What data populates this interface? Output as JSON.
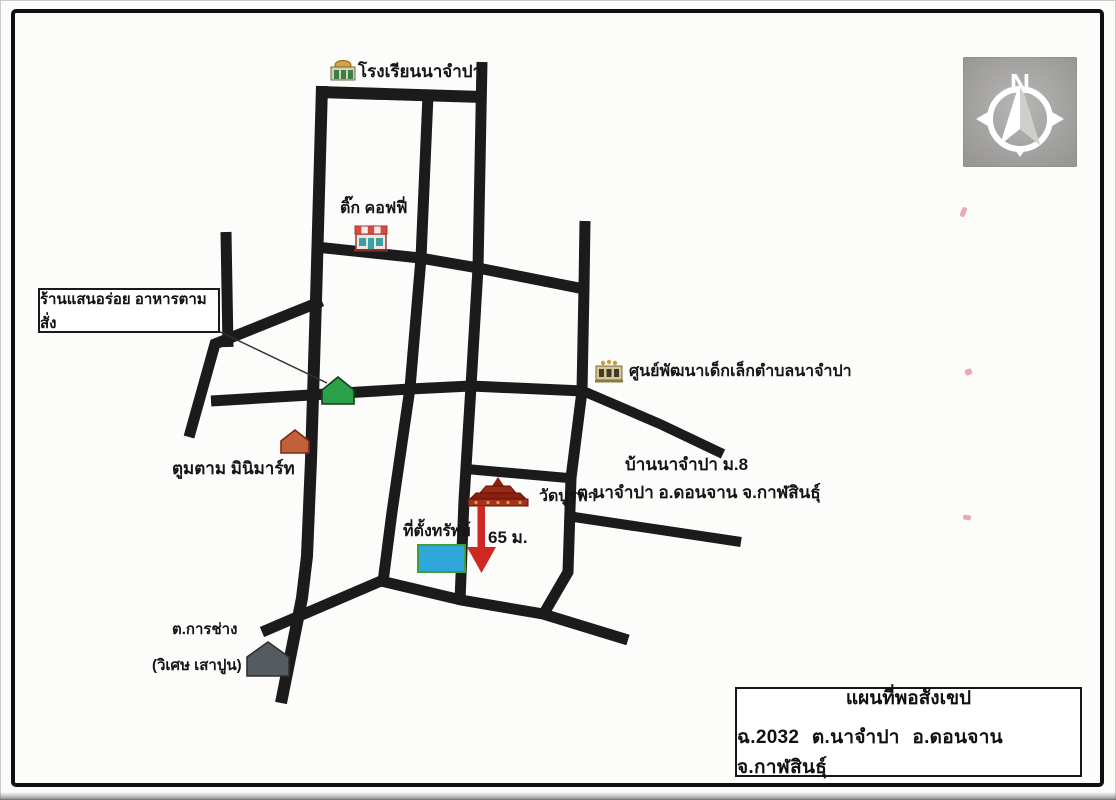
{
  "map": {
    "labels": {
      "school": "โรงเรียนนาจำปา",
      "coffee_shop": "ติ๊ก คอฟฟี่",
      "restaurant_callout": "ร้านแสนอร่อย อาหารตามสั่ง",
      "minimart": "ตูมตาม มินิมาร์ท",
      "childcare_center": "ศูนย์พัฒนาเด็กเล็กตำบลนาจำปา",
      "village_name": "บ้านนาจำปา ม.8",
      "village_address": "ต.นาจำปา อ.ดอนจาน จ.กาฬสินธุ์",
      "temple": "วัดบูรพา",
      "property_site": "ที่ตั้งทรัพย์",
      "distance": "65 ม.",
      "workshop_name": "ต.การช่าง",
      "workshop_detail": "(วิเศษ เสาปูน)"
    },
    "compass": {
      "north_letter": "N"
    },
    "title_box": {
      "line1": "แผนที่พอสังเขป",
      "line2": "ฉ.2032 ต.นาจำปา อ.ดอนจาน จ.กาฬสินธุ์"
    },
    "colors": {
      "road": "#1b1b1b",
      "property_fill": "#2fa7d9",
      "property_border": "#3f9e3f",
      "arrow_red": "#ce2823",
      "green_house": "#2aa148",
      "orange_house": "#c2603b",
      "gray_house": "#565b5f",
      "temple_red": "#8c1f13",
      "compass_bg": "#a5a4a2"
    }
  }
}
